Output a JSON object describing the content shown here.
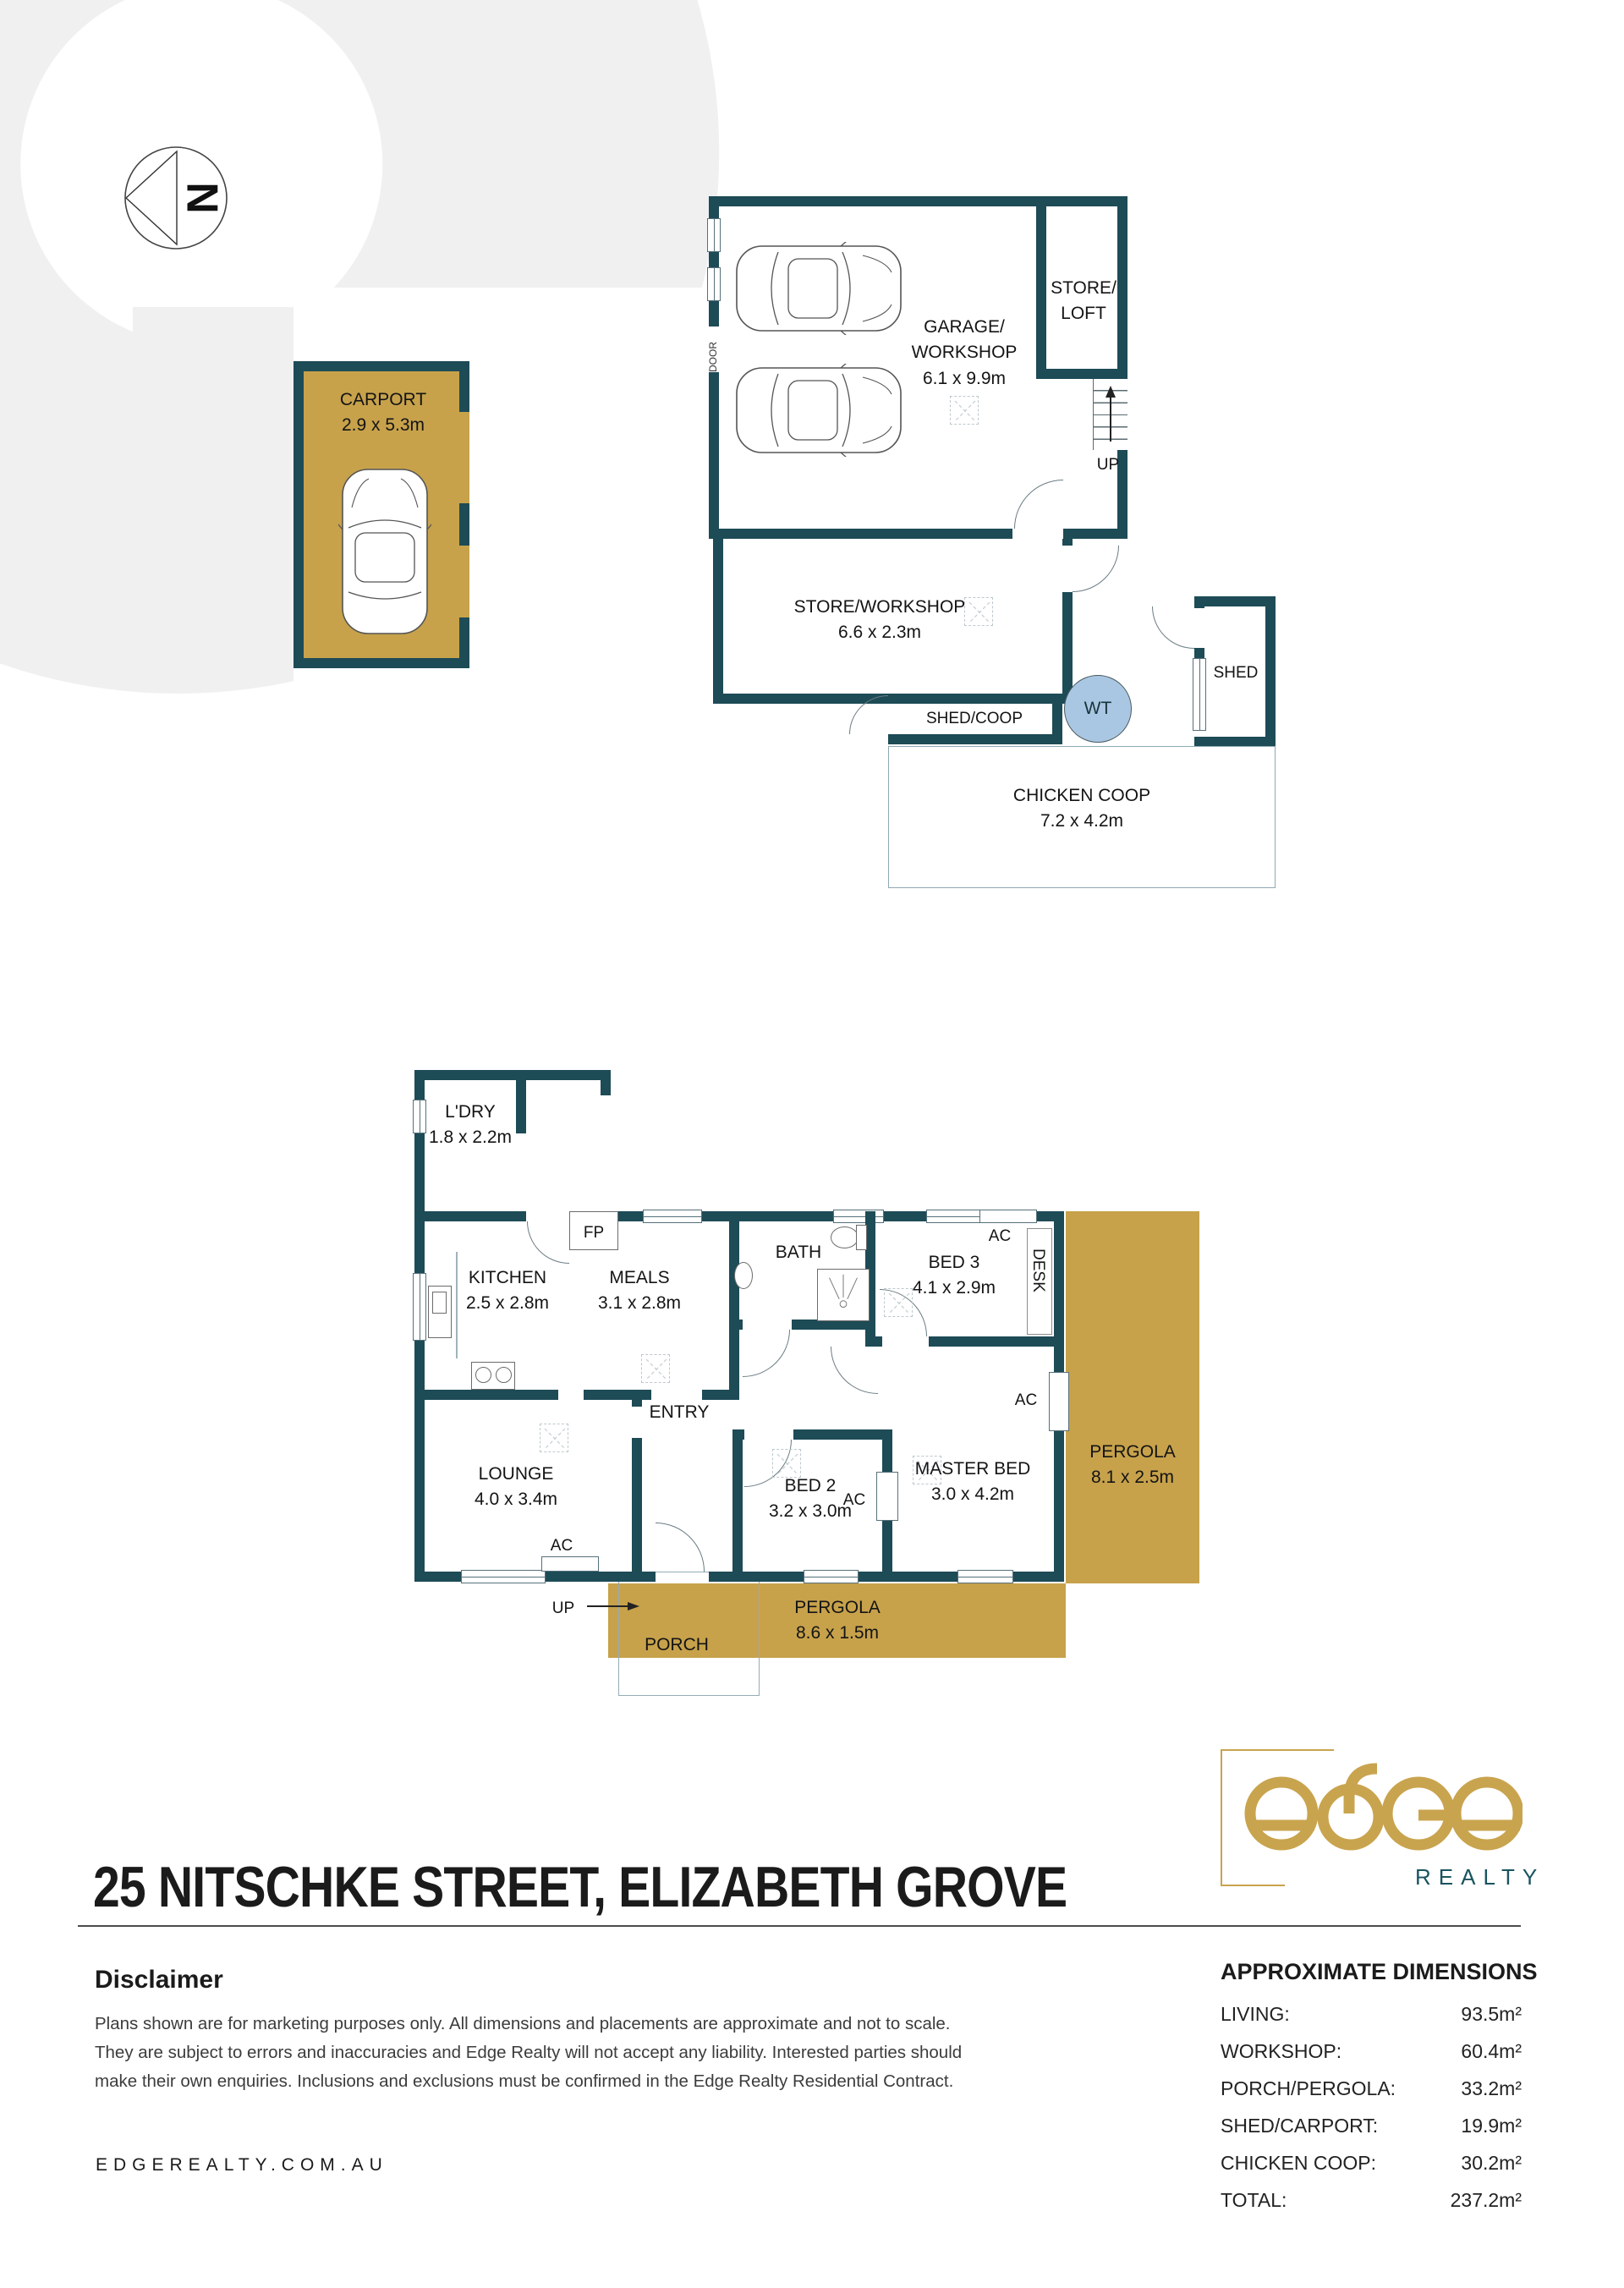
{
  "colors": {
    "teal": "#1d4b56",
    "gold": "#c7a24b",
    "wt": "#a9c7e2",
    "watermark": "#f0f0f1",
    "brand_gold": "#c9a44e",
    "brand_teal": "#19545f"
  },
  "compass": {
    "n": "N"
  },
  "outbuildings": {
    "carport": {
      "name": "CARPORT",
      "dims": "2.9 x 5.3m"
    },
    "garage": {
      "line1": "GARAGE/",
      "line2": "WORKSHOP",
      "dims": "6.1 x 9.9m"
    },
    "store_loft": {
      "line1": "STORE/",
      "line2": "LOFT"
    },
    "up": "UP",
    "door": "DOOR",
    "store_workshop": {
      "name": "STORE/WORKSHOP",
      "dims": "6.6 x 2.3m"
    },
    "shed_coop": {
      "name": "SHED/COOP"
    },
    "wt": "WT",
    "shed": {
      "name": "SHED"
    },
    "chicken_coop": {
      "name": "CHICKEN COOP",
      "dims": "7.2 x 4.2m"
    }
  },
  "house": {
    "ldry": {
      "name": "L'DRY",
      "dims": "1.8 x 2.2m"
    },
    "kitchen": {
      "name": "KITCHEN",
      "dims": "2.5 x 2.8m"
    },
    "meals": {
      "name": "MEALS",
      "dims": "3.1 x 2.8m"
    },
    "fp": "FP",
    "bath": {
      "name": "BATH"
    },
    "bed3": {
      "name": "BED 3",
      "dims": "4.1 x 2.9m"
    },
    "desk": "DESK",
    "ac": "AC",
    "entry": "ENTRY",
    "up": "UP",
    "lounge": {
      "name": "LOUNGE",
      "dims": "4.0 x 3.4m"
    },
    "bed2": {
      "name": "BED 2",
      "dims": "3.2 x 3.0m"
    },
    "master": {
      "name": "MASTER BED",
      "dims": "3.0 x 4.2m"
    },
    "porch": "PORCH",
    "pergola_side": {
      "name": "PERGOLA",
      "dims": "8.1 x 2.5m"
    },
    "pergola_rear": {
      "name": "PERGOLA",
      "dims": "8.6 x 1.5m"
    }
  },
  "footer": {
    "title": "25 NITSCHKE STREET, ELIZABETH GROVE",
    "disclaimer_heading": "Disclaimer",
    "disclaimer_lines": [
      "Plans shown are for marketing purposes only. All dimensions and placements are approximate and not to scale.",
      "They are subject to errors and inaccuracies and Edge Realty will not accept any liability. Interested parties should",
      "make their own enquiries. Inclusions and exclusions must be confirmed in the Edge Realty Residential Contract."
    ],
    "website": "EDGEREALTY.COM.AU",
    "brand": {
      "realty": "REALTY"
    },
    "dimensions": {
      "heading": "APPROXIMATE DIMENSIONS",
      "rows": [
        {
          "label": "LIVING:",
          "value": "93.5m²"
        },
        {
          "label": "WORKSHOP:",
          "value": "60.4m²"
        },
        {
          "label": "PORCH/PERGOLA:",
          "value": "33.2m²"
        },
        {
          "label": "SHED/CARPORT:",
          "value": "19.9m²"
        },
        {
          "label": "CHICKEN COOP:",
          "value": "30.2m²"
        },
        {
          "label": "TOTAL:",
          "value": "237.2m²"
        }
      ]
    }
  }
}
